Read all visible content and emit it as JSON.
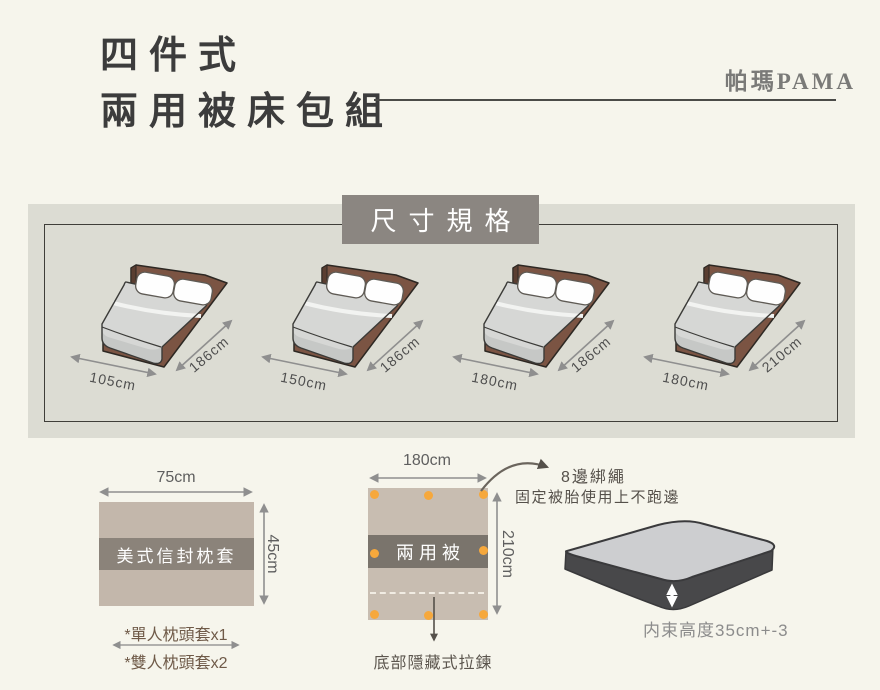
{
  "header": {
    "title_line1": "四件式",
    "title_line2": "兩用被床包組",
    "brand": "帕瑪PAMA"
  },
  "spec_panel": {
    "title": "尺寸規格",
    "beds": [
      {
        "width_label": "105cm",
        "length_label": "186cm"
      },
      {
        "width_label": "150cm",
        "length_label": "186cm"
      },
      {
        "width_label": "180cm",
        "length_label": "186cm"
      },
      {
        "width_label": "180cm",
        "length_label": "210cm"
      }
    ]
  },
  "pillowcase": {
    "width_label": "75cm",
    "height_label": "45cm",
    "name": "美式信封枕套",
    "note1": "*單人枕頭套x1",
    "note2": "*雙人枕頭套x2"
  },
  "quilt": {
    "width_label": "180cm",
    "height_label": "210cm",
    "name": "兩用被",
    "tie_title": "8邊綁繩",
    "tie_desc": "固定被胎使用上不跑邊",
    "zipper_note": "底部隱藏式拉鍊"
  },
  "mattress": {
    "height_note": "内束高度35cm+-3"
  },
  "colors": {
    "page_bg": "#f6f5ec",
    "panel_bg": "#dcdcd3",
    "title_box": "#8b8681",
    "bed_brown": "#7b5443",
    "mattress_gray": "#d6d7d5",
    "pillow_tan": "#c3b7ab",
    "band_gray": "#8b837a",
    "quilt_tan": "#c8bdb1",
    "quilt_band": "#7a746c",
    "dot_orange": "#f6a83c",
    "note_brown": "#6f5a48"
  }
}
